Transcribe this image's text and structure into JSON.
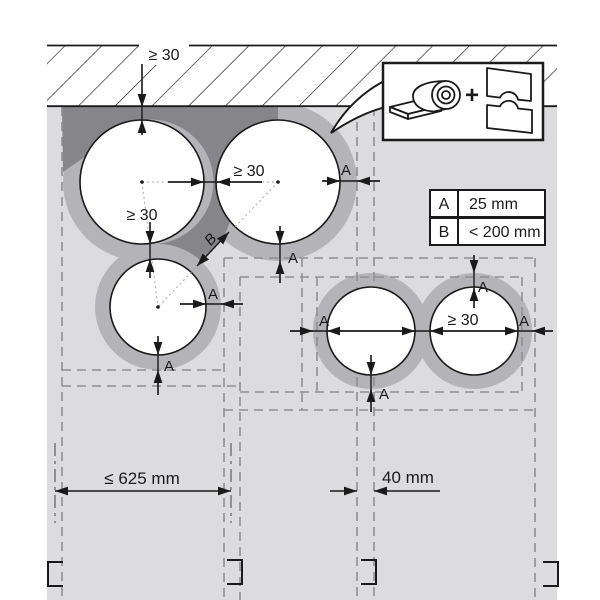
{
  "diagram_title": "pipe-insulation-clearance-diagram",
  "labels": {
    "min_gap": "≥ 30",
    "a": "A",
    "b": "B",
    "stud_spacing": "≤ 625 mm",
    "stud_width": "40 mm",
    "plus": "+"
  },
  "legend": {
    "rows": [
      {
        "key": "A",
        "value": "25 mm"
      },
      {
        "key": "B",
        "value": "< 200 mm"
      }
    ]
  },
  "colors": {
    "background": "#ffffff",
    "cavity_gray": "#dcdcde",
    "insulation_gray": "#b4b4b8",
    "mortar_gray": "#85858a",
    "dashed_line_gray": "#8f8f93",
    "centerline_gray": "#6f6f73",
    "ink_black": "#1a1a1a"
  }
}
